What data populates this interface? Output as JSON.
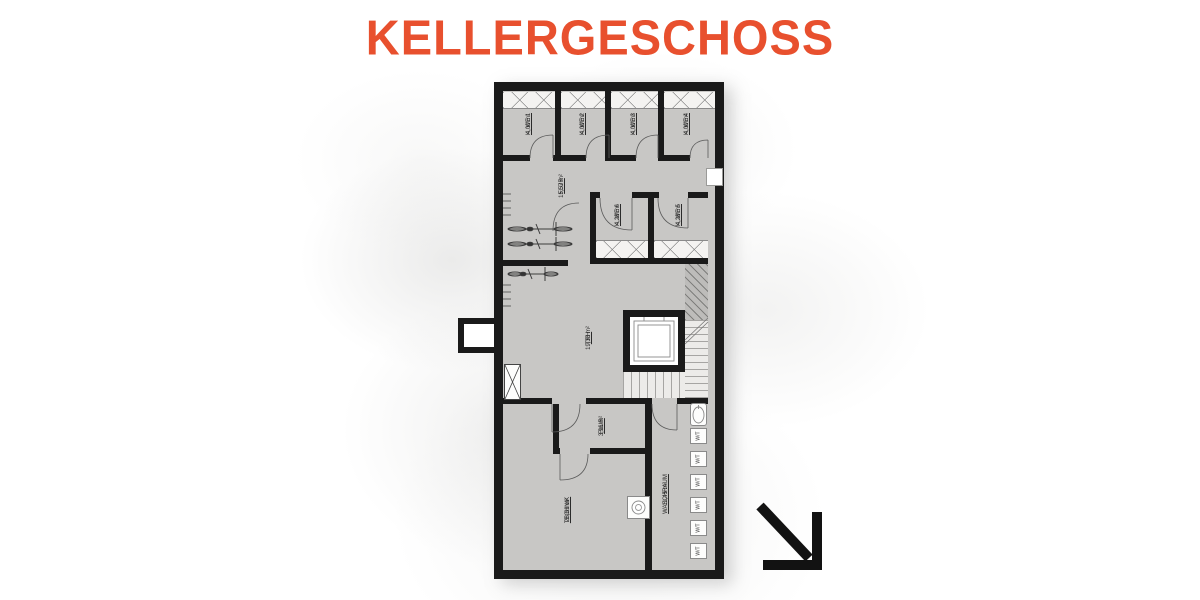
{
  "page": {
    "title": "KELLERGESCHOSS",
    "title_color": "#e8502e"
  },
  "floor_plan": {
    "rooms": [
      {
        "name": "K. WE 1",
        "area": "4,00 m²"
      },
      {
        "name": "K. WE 2",
        "area": "4,00 m²"
      },
      {
        "name": "K. WE 3",
        "area": "4,00 m²"
      },
      {
        "name": "K. WE 4",
        "area": "4,00 m²"
      },
      {
        "name": "FLUR",
        "area": "15,57 m²"
      },
      {
        "name": "K. WE 6",
        "area": "4,28 m²"
      },
      {
        "name": "K. WE 5",
        "area": "4,28 m²"
      },
      {
        "name": "TRH",
        "area": "19,33 m²"
      },
      {
        "name": "FLUR",
        "area": "3,96 m²"
      },
      {
        "name": "TECHNIK",
        "area": "28,61 m²"
      },
      {
        "name": "WASCHRAUM",
        "area": "11,45 m²"
      }
    ],
    "laundry_units": [
      {
        "label": "W/T"
      },
      {
        "label": "W/T"
      },
      {
        "label": "W/T"
      },
      {
        "label": "W/T"
      },
      {
        "label": "W/T"
      },
      {
        "label": "W/T"
      }
    ],
    "colors": {
      "floor": "#c8c7c5",
      "wall": "#1a1a1a",
      "accent": "#e8502e"
    },
    "icons": {
      "direction_arrow": "arrow-down-right",
      "bicycles": "bicycle-top-view",
      "elevator": "elevator-shaft",
      "stairs": "stair-treads",
      "sink": "sink-basin",
      "boiler": "round-unit"
    }
  }
}
